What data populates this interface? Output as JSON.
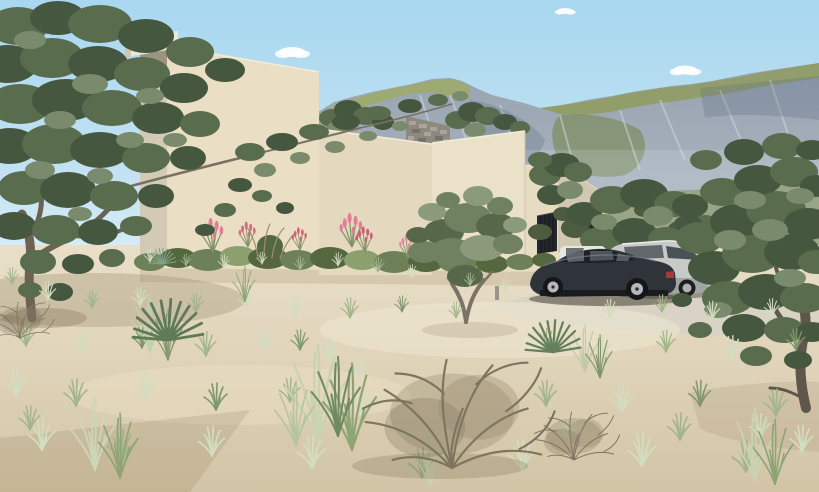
{
  "scene": {
    "type": "architectural-exterior-rendering",
    "description": "Photorealistic 3D rendering of a modern flat-roof beige stucco villa on a sandy desert plot with olive trees, dune grass tufts, a dry twiggy shrub, pink flowering planting beds, two dark cars parked on a light driveway, and a rocky green mountain ridge under a clear blue sky"
  },
  "palette": {
    "sky_top": "#a8d7ef",
    "sky_horizon": "#dbeef7",
    "cloud": "#ffffff",
    "rock": "#97a2b0",
    "rock_light": "#b5bec7",
    "rock_streak": "#d2d9df",
    "rock_shade": "#5f7085",
    "green_crest": "#8f9c60",
    "green_bright": "#9dab6a",
    "green_dark": "#77874f",
    "hill_base": "#7e8c54",
    "wall_front": "#eadfc5",
    "wall_mid": "#e4d9bf",
    "wall_bright": "#ebe1c8",
    "wall_b": "#e6dcc2",
    "wall_shadow": "#d2c8b1",
    "wall_left": "#d3cab5",
    "cap": "#f1e8d2",
    "cap_shadow": "#9d9380",
    "stone": "#8d897f",
    "stone_light": "#a9a59b",
    "stone_dark": "#75716a",
    "garage_door": "#24282c",
    "door_slat": "#121417",
    "window": "#20242a",
    "window_frame": "#d8d0bc",
    "sand_top": "#e9dfc8",
    "sand_bottom": "#d2c4a5",
    "sand_bright": "#f2ead4",
    "sand_shadow": "#8a7452",
    "driveway": "#d9d3c6",
    "olive_dark": "#46573f",
    "olive_mid": "#5a6c4e",
    "olive_light": "#798b6c",
    "trunk": "#6b6254",
    "trunk_light": "#7b7365",
    "grass_pale": "#d4dcc0",
    "grass_green": "#a3b58b",
    "grass_deep": "#80976c",
    "yucca": "#5e7a57",
    "reed_pale": "#c9d3b2",
    "reed_green": "#8ea474",
    "twig": "#7e7560",
    "twig_fill": "#85795f",
    "flower_pink": "#e07e95",
    "flower_deep": "#c95f74",
    "shrub_red": "#8e4a40",
    "car_dark": "#2f343a",
    "car_dark_glass": "#1e2226",
    "car_reflect": "#6b747c",
    "car_silver": "#c7cac7",
    "car_silver_dark": "#9aa09d",
    "glass_silver": "#4b5257",
    "car_white": "#e6e8e4",
    "tire": "#141618",
    "rim": "#b5b9bc",
    "taillight": "#a23c36",
    "taillight_silver": "#8e3a36"
  },
  "objects": {
    "sky": {
      "label": "clear blue sky",
      "cloud_count": 4
    },
    "mountains": {
      "label": "rocky limestone ridge with olive-green slopes"
    },
    "house": {
      "label": "modern beige stucco villa of stacked flat-roof volumes",
      "features": [
        "overhanging roof cap on tall volume",
        "stepped parapets",
        "rubble stone wall section",
        "dark sectional garage door",
        "narrow dark window",
        "roof-level shrubs",
        "flowering desert planting bed"
      ]
    },
    "vehicles": [
      {
        "label": "dark charcoal luxury coupe",
        "position": "foreground driveway, facing left"
      },
      {
        "label": "silver estate car",
        "position": "behind coupe"
      },
      {
        "label": "white car",
        "position": "barely visible behind coupe roof"
      }
    ],
    "vegetation": {
      "trees": "gnarled olive trees (large left foreground, mid-ground by garage, right foreground, behind cars)",
      "ground": "pale dune grass tufts, yucca rosettes, tall reed clumps, dry leafless twig shrub",
      "flowers": "pink flower spikes along house base"
    },
    "ground": {
      "label": "sandy desert plot with light concrete driveway and soft dune shadows"
    }
  },
  "ground_cover": {
    "variants": {
      "0": "#d4dcc0",
      "1": "#a3b58b",
      "2": "#80976c"
    },
    "tufts": [
      [
        150,
        262,
        0.5,
        0
      ],
      [
        186,
        266,
        0.45,
        1
      ],
      [
        224,
        268,
        0.5,
        0
      ],
      [
        262,
        264,
        0.45,
        0
      ],
      [
        300,
        270,
        0.5,
        1
      ],
      [
        338,
        266,
        0.5,
        0
      ],
      [
        378,
        272,
        0.55,
        1
      ],
      [
        412,
        278,
        0.5,
        0
      ],
      [
        470,
        286,
        0.5,
        1
      ],
      [
        505,
        292,
        0.5,
        0
      ],
      [
        12,
        284,
        0.6,
        1
      ],
      [
        48,
        300,
        0.7,
        0
      ],
      [
        92,
        308,
        0.65,
        1
      ],
      [
        140,
        306,
        0.7,
        0
      ],
      [
        196,
        312,
        0.7,
        1
      ],
      [
        246,
        308,
        0.65,
        0
      ],
      [
        296,
        316,
        0.7,
        0
      ],
      [
        350,
        318,
        0.75,
        1
      ],
      [
        402,
        312,
        0.6,
        2
      ],
      [
        456,
        318,
        0.6,
        1
      ],
      [
        610,
        318,
        0.7,
        0
      ],
      [
        662,
        312,
        0.65,
        1
      ],
      [
        712,
        320,
        0.7,
        0
      ],
      [
        772,
        316,
        0.65,
        0
      ],
      [
        26,
        346,
        0.8,
        1
      ],
      [
        82,
        352,
        0.85,
        0
      ],
      [
        142,
        348,
        0.8,
        2
      ],
      [
        206,
        356,
        0.9,
        1
      ],
      [
        266,
        350,
        0.8,
        0
      ],
      [
        330,
        362,
        0.9,
        0
      ],
      [
        546,
        350,
        0.8,
        1
      ],
      [
        602,
        358,
        0.85,
        0
      ],
      [
        666,
        352,
        0.8,
        1
      ],
      [
        732,
        360,
        0.9,
        0
      ],
      [
        796,
        350,
        0.8,
        2
      ],
      [
        16,
        396,
        1,
        0
      ],
      [
        76,
        406,
        1,
        1
      ],
      [
        146,
        398,
        0.95,
        0
      ],
      [
        216,
        410,
        1,
        2
      ],
      [
        290,
        402,
        0.9,
        1
      ],
      [
        362,
        416,
        1,
        0
      ],
      [
        546,
        406,
        0.95,
        1
      ],
      [
        622,
        412,
        1,
        0
      ],
      [
        700,
        406,
        0.95,
        2
      ],
      [
        776,
        416,
        1,
        1
      ],
      [
        42,
        450,
        1.15,
        0
      ],
      [
        122,
        462,
        1.2,
        1
      ],
      [
        212,
        456,
        1.1,
        0
      ],
      [
        312,
        468,
        1.2,
        0
      ],
      [
        422,
        478,
        1.1,
        1
      ],
      [
        522,
        470,
        1.15,
        0
      ],
      [
        642,
        466,
        1.2,
        0
      ],
      [
        746,
        472,
        1.15,
        1
      ],
      [
        802,
        452,
        1,
        0
      ],
      [
        570,
        440,
        0.9,
        0
      ],
      [
        680,
        440,
        1,
        1
      ],
      [
        760,
        438,
        0.9,
        0
      ],
      [
        30,
        430,
        0.9,
        1
      ],
      [
        360,
        378,
        0.8,
        0
      ],
      [
        300,
        350,
        0.75,
        2
      ]
    ]
  }
}
